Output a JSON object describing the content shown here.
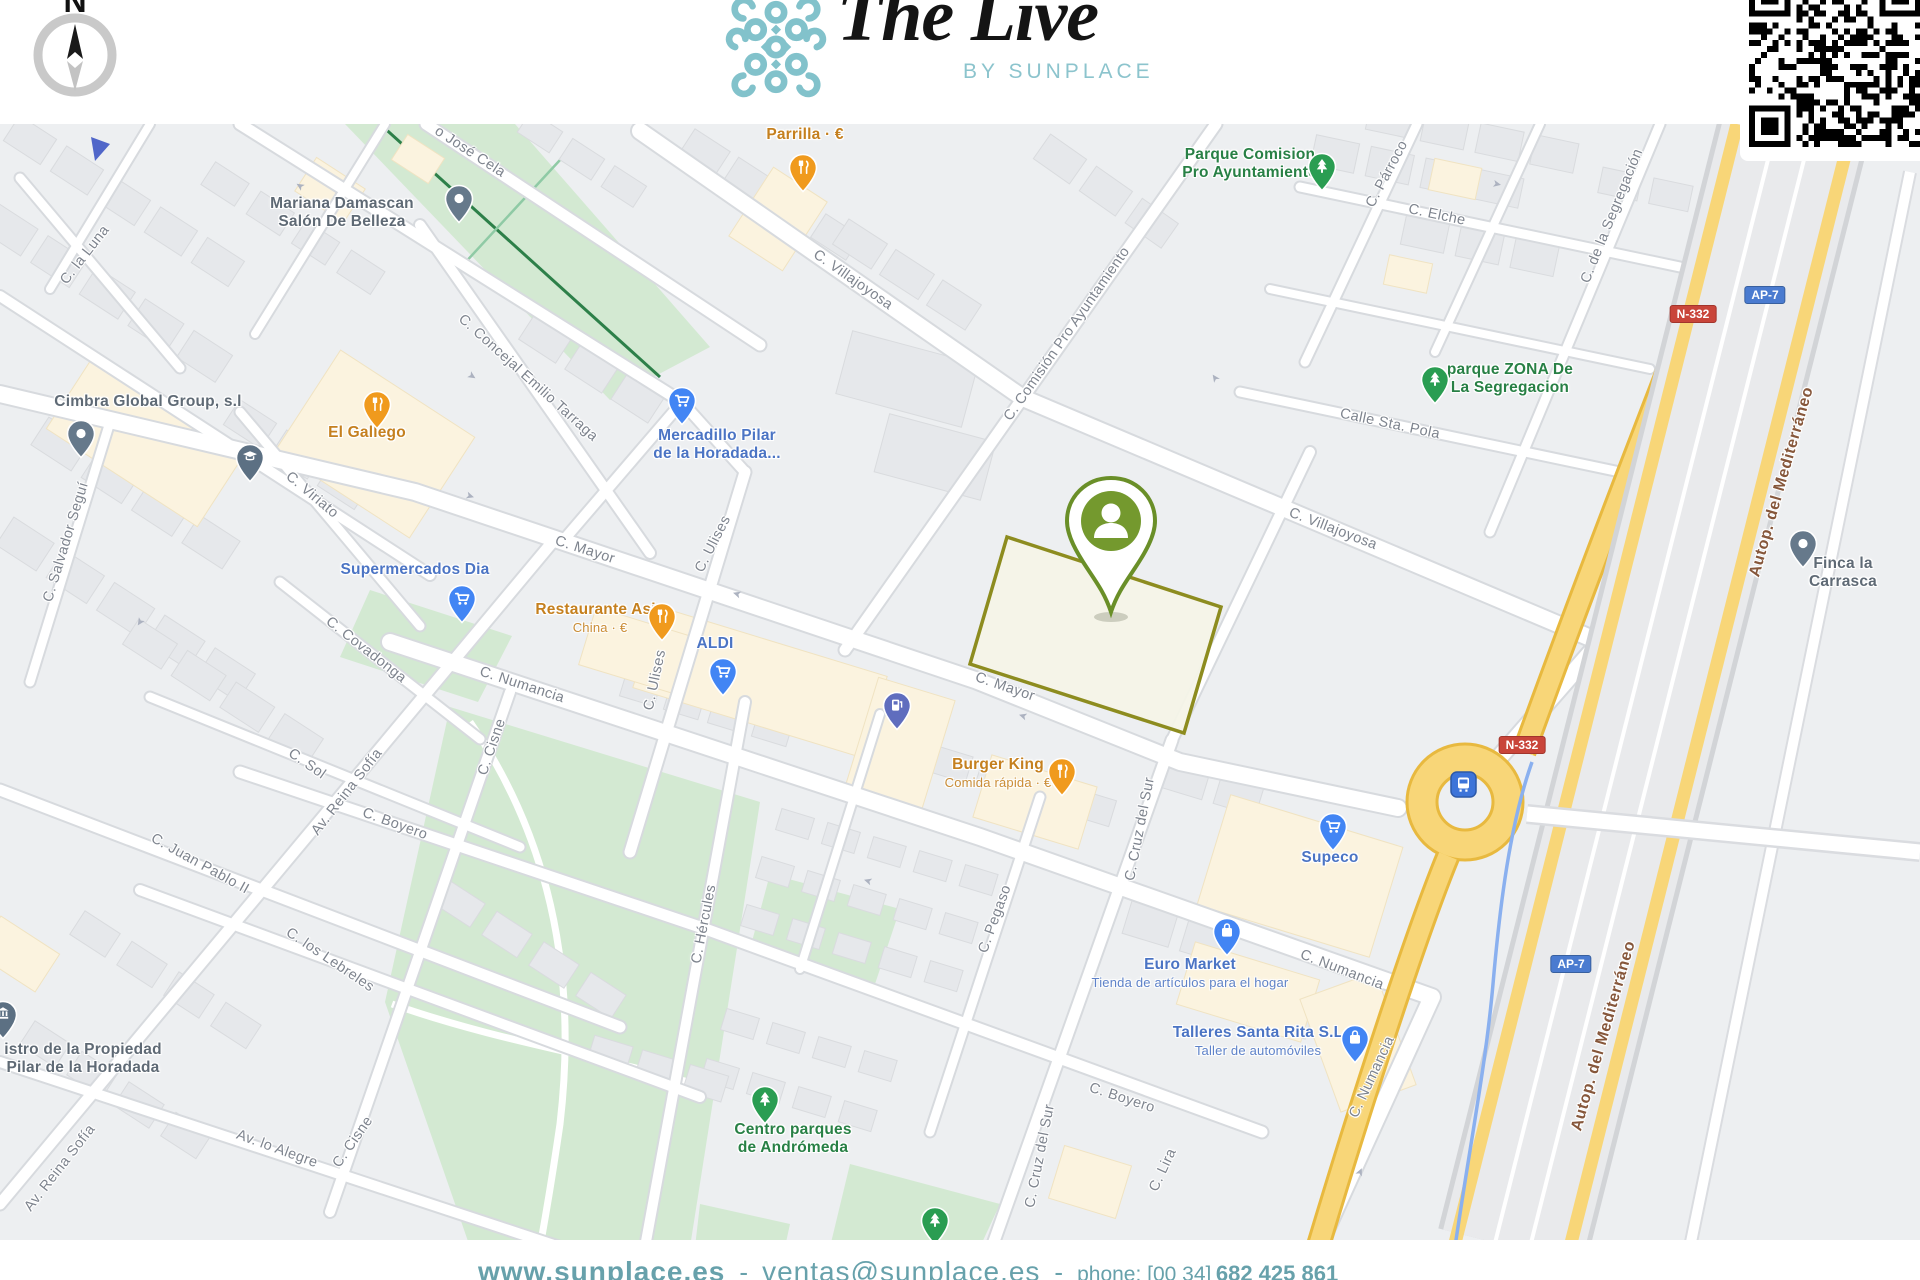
{
  "header": {
    "compass_letter": "N",
    "logo_title": "The Live",
    "logo_subtitle": "BY SUNPLACE"
  },
  "footer": {
    "website": "www.sunplace.es",
    "separator": "-",
    "email": "ventas@sunplace.es",
    "phone_label": "phone: [00 34]",
    "phone_number": "682 425 861"
  },
  "colors": {
    "brand_teal": "#7fbfca",
    "footer_teal": "#67a1ab",
    "marker_green": "#74992e",
    "parcel_outline": "#8d8c1f",
    "poi_blue": "#4b74c4",
    "poi_orange": "#c5801f",
    "poi_green": "#288045",
    "poi_gray": "#5f6a75",
    "road_yellow": "#f8d678",
    "badge_red": "#c9453a",
    "badge_blue": "#4a7bd0",
    "highway_label_brown": "#86573b"
  },
  "map": {
    "marker": {
      "id": "property-marker",
      "icon": "person-pin",
      "color": "#74992e"
    },
    "pois": [
      {
        "id": "parrilla",
        "name": "Parrilla · €",
        "category": "food",
        "icon": "restaurant"
      },
      {
        "id": "parque-comision",
        "name": "Parque Comision\nPro Ayuntamiento",
        "category": "park",
        "icon": "tree"
      },
      {
        "id": "mariana",
        "name": "Mariana Damascan\nSalón De Belleza",
        "category": "place",
        "icon": "dot"
      },
      {
        "id": "cimbra",
        "name": "Cimbra Global Group, s.l",
        "category": "place",
        "icon": "dot"
      },
      {
        "id": "el-gallego",
        "name": "El Gallego",
        "category": "food",
        "icon": "restaurant"
      },
      {
        "id": "mercadillo",
        "name": "Mercadillo Pilar\nde la Horadada...",
        "category": "shop",
        "icon": "cart"
      },
      {
        "id": "supermercados-dia",
        "name": "Supermercados Dia",
        "category": "shop",
        "icon": "cart"
      },
      {
        "id": "restaurante-asia",
        "name": "Restaurante Asia",
        "subtitle": "China · €",
        "category": "food",
        "icon": "restaurant"
      },
      {
        "id": "aldi",
        "name": "ALDI",
        "category": "shop",
        "icon": "cart"
      },
      {
        "id": "burger-king",
        "name": "Burger King",
        "subtitle": "Comida rápida · €",
        "category": "food",
        "icon": "restaurant"
      },
      {
        "id": "supeco",
        "name": "Supeco",
        "category": "shop",
        "icon": "cart"
      },
      {
        "id": "euro-market",
        "name": "Euro Market",
        "subtitle": "Tienda de artículos para el hogar",
        "category": "shop",
        "icon": "bag"
      },
      {
        "id": "talleres",
        "name": "Talleres Santa Rita S.L",
        "subtitle": "Taller de automóviles",
        "category": "shop",
        "icon": "bag"
      },
      {
        "id": "centro-parques",
        "name": "Centro parques\nde Andrómeda",
        "category": "park",
        "icon": "tree"
      },
      {
        "id": "parque-zona",
        "name": "parque ZONA De\nLa Segregacion",
        "category": "park",
        "icon": "tree"
      },
      {
        "id": "finca",
        "name": "Finca la Carrasca",
        "category": "place",
        "icon": "dot"
      },
      {
        "id": "registro",
        "name": "istro de la Propiedad\nPilar de la Horadada",
        "category": "place",
        "icon": "bank"
      }
    ],
    "icon_pins": [
      {
        "id": "education",
        "icon": "cap"
      },
      {
        "id": "fuel-station",
        "icon": "fuel"
      },
      {
        "id": "transit-stop",
        "icon": "bus"
      },
      {
        "id": "park-tree-small",
        "icon": "tree"
      },
      {
        "id": "partial-pin",
        "icon": "partial"
      }
    ],
    "streets": [
      {
        "id": "jose-cela",
        "name": "o José Cela"
      },
      {
        "id": "la-luna",
        "name": "C. la Luna"
      },
      {
        "id": "salvador-segui",
        "name": "C. Salvador Seguí"
      },
      {
        "id": "concejal",
        "name": "C. Concejal Emilio Tarraga"
      },
      {
        "id": "viriato",
        "name": "C. Viriato"
      },
      {
        "id": "mayor-1",
        "name": "C. Mayor"
      },
      {
        "id": "mayor-2",
        "name": "C. Mayor"
      },
      {
        "id": "ulises-1",
        "name": "C. Ulises"
      },
      {
        "id": "ulises-2",
        "name": "C. Ulises"
      },
      {
        "id": "villajoyosa-1",
        "name": "C. Villajoyosa"
      },
      {
        "id": "villajoyosa-2",
        "name": "C. Villajoyosa"
      },
      {
        "id": "comision",
        "name": "C. Comisión Pro Ayuntamiento"
      },
      {
        "id": "parroco",
        "name": "C. Párroco"
      },
      {
        "id": "elche",
        "name": "C. Elche"
      },
      {
        "id": "segregacion",
        "name": "C. de la Segregación"
      },
      {
        "id": "sta-pola",
        "name": "Calle Sta. Pola"
      },
      {
        "id": "covadonga",
        "name": "C. Covadonga"
      },
      {
        "id": "numancia-1",
        "name": "C. Numancia"
      },
      {
        "id": "numancia-2",
        "name": "C. Numancia"
      },
      {
        "id": "numancia-3",
        "name": "C. Numancia"
      },
      {
        "id": "cisne-1",
        "name": "C. Cisne"
      },
      {
        "id": "cisne-2",
        "name": "C. Cisne"
      },
      {
        "id": "sol",
        "name": "C. Sol"
      },
      {
        "id": "reina-sofia-1",
        "name": "Av. Reina Sofía"
      },
      {
        "id": "reina-sofia-2",
        "name": "Av. Reina Sofía"
      },
      {
        "id": "boyero-1",
        "name": "C. Boyero"
      },
      {
        "id": "boyero-2",
        "name": "C. Boyero"
      },
      {
        "id": "lebreles",
        "name": "C. los Lebreles"
      },
      {
        "id": "juan-pablo",
        "name": "C. Juan Pablo II"
      },
      {
        "id": "alegre",
        "name": "Av. lo Alegre"
      },
      {
        "id": "hercules",
        "name": "C. Hércules"
      },
      {
        "id": "pegaso",
        "name": "C. Pegaso"
      },
      {
        "id": "cruz-1",
        "name": "C. Cruz del Sur"
      },
      {
        "id": "cruz-2",
        "name": "C. Cruz del Sur"
      },
      {
        "id": "lira",
        "name": "C. Lira"
      },
      {
        "id": "autop-1",
        "name": "Autop. del Mediterráneo",
        "hwy": true
      },
      {
        "id": "autop-2",
        "name": "Autop. del Mediterráneo",
        "hwy": true
      }
    ],
    "badges": [
      {
        "id": "n332-a",
        "text": "N-332",
        "style": "red"
      },
      {
        "id": "n332-b",
        "text": "N-332",
        "style": "red"
      },
      {
        "id": "ap7-a",
        "text": "AP-7",
        "style": "blue"
      },
      {
        "id": "ap7-b",
        "text": "AP-7",
        "style": "blue"
      }
    ]
  }
}
